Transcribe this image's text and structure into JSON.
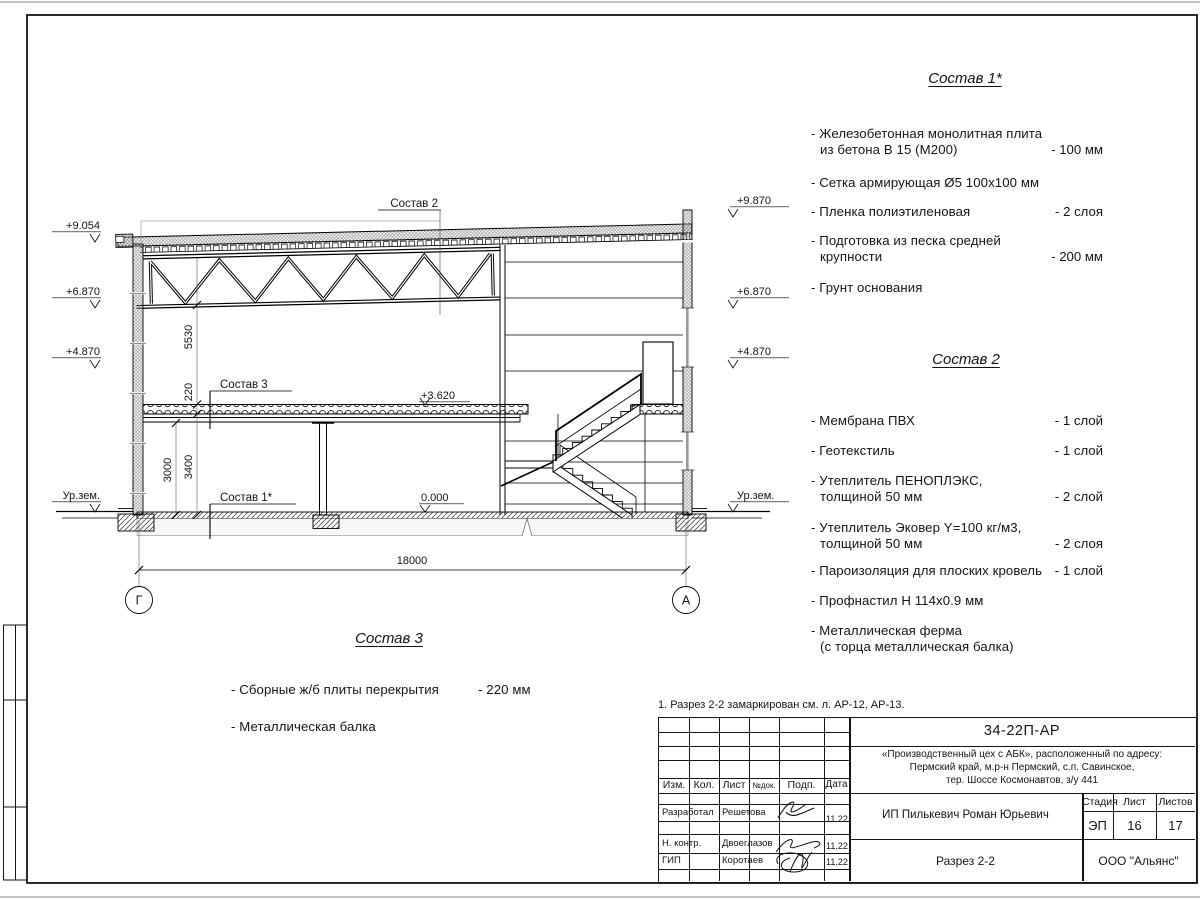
{
  "note": "1. Разрез 2-2 замаркирован см. л. АР-12, АР-13.",
  "comps": [
    {
      "title": "Состав 1*",
      "items": [
        {
          "l1": "- Железобетонная  монолитная плита",
          "l2": "из бетона В 15 (М200)",
          "v": "- 100 мм"
        },
        {
          "l1": "- Сетка армирующая Ø5 100х100 мм",
          "l2": "",
          "v": ""
        },
        {
          "l1": "- Пленка полиэтиленовая",
          "l2": "",
          "v": "-  2 слоя"
        },
        {
          "l1": "- Подготовка из песка средней",
          "l2": "крупности",
          "v": "- 200 мм"
        },
        {
          "l1": "- Грунт основания",
          "l2": "",
          "v": ""
        }
      ]
    },
    {
      "title": "Состав 2",
      "items": [
        {
          "l1": "- Мембрана ПВХ",
          "l2": "",
          "v": "- 1 слой"
        },
        {
          "l1": "- Геотекстиль",
          "l2": "",
          "v": "- 1 слой"
        },
        {
          "l1": "- Утеплитель ПЕНОПЛЭКС,",
          "l2": "толщиной 50 мм",
          "v": "- 2 слой"
        },
        {
          "l1": "- Утеплитель Эковер Y=100 кг/м3,",
          "l2": "толщиной 50 мм",
          "v": "- 2 слоя"
        },
        {
          "l1": "- Пароизоляция для плоских кровель",
          "l2": "",
          "v": "- 1 слой"
        },
        {
          "l1": "- Профнастил Н 114х0.9 мм",
          "l2": "",
          "v": ""
        },
        {
          "l1": "- Металлическая ферма",
          "l2": "(с торца металлическая балка)",
          "v": ""
        }
      ]
    },
    {
      "title": "Состав 3",
      "items": [
        {
          "l1": "- Сборные ж/б  плиты перекрытия",
          "l2": "",
          "v": "- 220 мм"
        },
        {
          "l1": "- Металлическая балка",
          "l2": "",
          "v": ""
        }
      ]
    }
  ],
  "drawing": {
    "callouts": [
      "Состав 2",
      "Состав 3",
      "Состав 1*"
    ],
    "levels_left": [
      "+9.054",
      "+6.870",
      "+4.870",
      "Ур.зем."
    ],
    "levels_right": [
      "+9.870",
      "+6.870",
      "+4.870",
      "Ур.зем."
    ],
    "level_floor2": "+3.620",
    "level_floor1": "0.000",
    "dims": {
      "span": "18000",
      "truss": "5530",
      "slab": "220",
      "h1": "3000",
      "h2": "3400"
    },
    "axes": [
      "Г",
      "А"
    ]
  },
  "title_block": {
    "doc_number": "34-22П-АР",
    "project_line1": "«Производственный цех с АБК», расположенный по адресу:",
    "project_line2": "Пермский край, м.р-н Пермский, с.п. Савинское,",
    "project_line3": "тер. Шоссе Космонавтов, з/у 441",
    "client": "ИП Пилькевич Роман Юрьевич",
    "sheet_title": "Разрез 2-2",
    "company": "ООО \"Альянс\"",
    "cols": {
      "izm": "Изм.",
      "kol": "Кол.",
      "list": "Лист",
      "ndok": "№док.",
      "podp": "Подп.",
      "data": "Дата"
    },
    "stage": {
      "label": "Стадия",
      "value": "ЭП"
    },
    "sheet": {
      "label": "Лист",
      "value": "16"
    },
    "sheets": {
      "label": "Листов",
      "value": "17"
    },
    "rows": [
      {
        "role": "Разработал",
        "name": "Решетова",
        "date": "11.22"
      },
      {
        "role": "Н. контр.",
        "name": "Двоеглазов",
        "date": "11.22"
      },
      {
        "role": "ГИП",
        "name": "Коротаев",
        "date": "11.22"
      }
    ]
  }
}
